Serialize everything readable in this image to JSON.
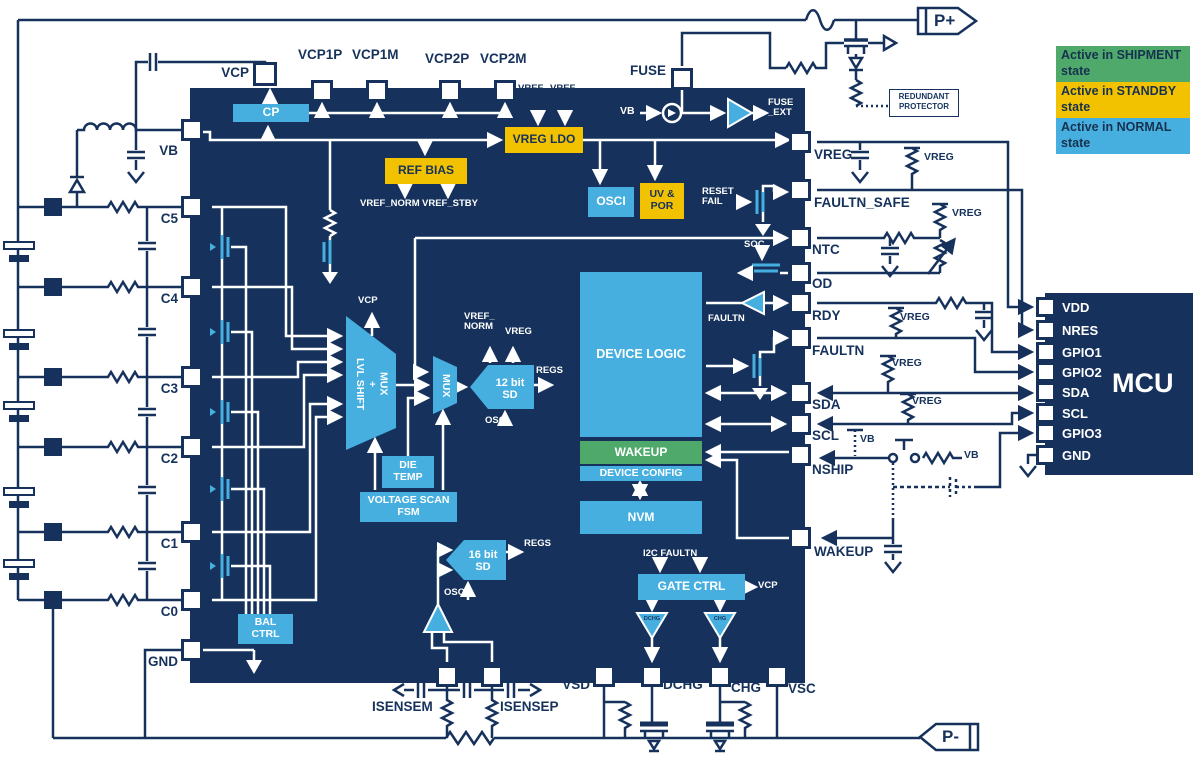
{
  "colors": {
    "navy": "#16325C",
    "blue": "#47AFE0",
    "yellow": "#F2C200",
    "green": "#4EA96A",
    "white": "#FFFFFF"
  },
  "legend": [
    {
      "label": "Active in SHIPMENT state",
      "color": "#4EA96A"
    },
    {
      "label": "Active in STANDBY state",
      "color": "#F2C200"
    },
    {
      "label": "Active in NORMAL state",
      "color": "#47AFE0"
    }
  ],
  "terminals": {
    "p_plus": "P+",
    "p_minus": "P-"
  },
  "annotations": {
    "redundant_protector": "REDUNDANT PROTECTOR",
    "vreg_pullup": "VREG",
    "vb": "VB"
  },
  "ic": {
    "pins": {
      "top": [
        "VCP",
        "VCP1P",
        "VCP1M",
        "VCP2P",
        "VCP2M",
        "FUSE"
      ],
      "left": [
        "VB",
        "C5",
        "C4",
        "C3",
        "C2",
        "C1",
        "C0",
        "GND"
      ],
      "right": [
        "VREG",
        "FAULTN_SAFE",
        "NTC",
        "OD",
        "RDY",
        "FAULTN",
        "SDA",
        "SCL",
        "NSHIP",
        "WAKEUP"
      ],
      "bottom": [
        "ISENSEM",
        "ISENSEP",
        "VSD",
        "DCHG",
        "CHG",
        "VSC"
      ]
    },
    "blocks": {
      "cp": "CP",
      "vreg_ldo": "VREG LDO",
      "ref_bias": "REF BIAS",
      "osci": "OSCI",
      "uv_por": "UV &\nPOR",
      "device_logic": "DEVICE LOGIC",
      "wakeup": "WAKEUP",
      "device_config": "DEVICE CONFIG",
      "nvm": "NVM",
      "gate_ctrl": "GATE  CTRL",
      "sd_12bit": "12 bit\nSD",
      "sd_16bit": "16 bit\nSD",
      "mux": "MUX",
      "lvl_shift_mux": "LVL SHIFT\n+\nMUX",
      "die_temp": "DIE\nTEMP",
      "voltage_scan_fsm": "VOLTAGE  SCAN\nFSM",
      "bal_ctrl": "BAL\nCTRL"
    },
    "signals": {
      "vref_norm_2l": "VREF_\nNORM",
      "vref_stby_2l": "VREF_\nSTBY",
      "vref_norm": "VREF_NORM",
      "vref_stby": "VREF_STBY",
      "vb": "VB",
      "fuse_ext": "FUSE\n_EXT",
      "reset_fail": "RESET\nFAIL",
      "soc": "SOC",
      "faultn": "FAULTN",
      "i2c_faultn": "I2C FAULTN",
      "vcp": "VCP",
      "regs": "REGS",
      "osci": "OSCI",
      "vreg": "VREG",
      "dchg_driver": "DCHG",
      "chg_driver": "CHG"
    }
  },
  "mcu": {
    "title": "MCU",
    "pins": [
      "VDD",
      "NRES",
      "GPIO1",
      "GPIO2",
      "SDA",
      "SCL",
      "GPIO3",
      "GND"
    ]
  }
}
